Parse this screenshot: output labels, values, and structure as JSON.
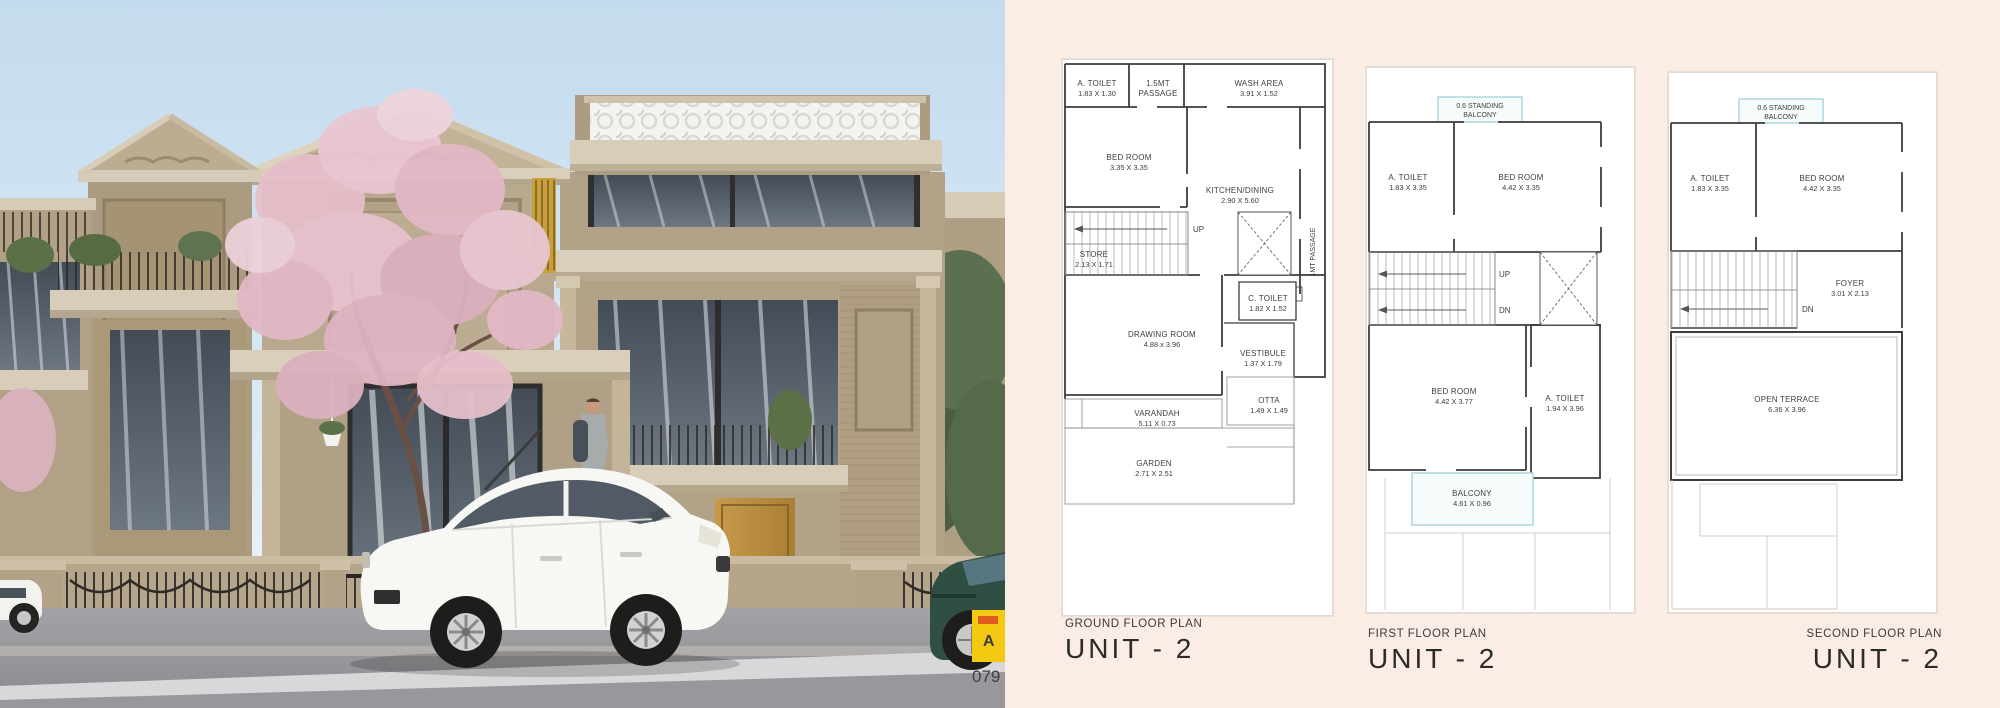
{
  "panel": {
    "background": "#fbede5"
  },
  "plans": [
    {
      "title": "GROUND FLOOR PLAN",
      "unit": "UNIT - 2",
      "rooms": [
        {
          "name": "A. TOILET",
          "dims": "1.83 X 1.30"
        },
        {
          "name": "1.5MT",
          "dims": "PASSAGE"
        },
        {
          "name": "WASH AREA",
          "dims": "3.91 X 1.52"
        },
        {
          "name": "BED ROOM",
          "dims": "3.35 X 3.35"
        },
        {
          "name": "KITCHEN/DINING",
          "dims": "2.90 X 5.60"
        },
        {
          "name": "STORE",
          "dims": "2.13 X 1.71"
        },
        {
          "name": "C. TOILET",
          "dims": "1.82 X 1.52"
        },
        {
          "name": "DRAWING ROOM",
          "dims": "4.88 x 3.96"
        },
        {
          "name": "VESTIBULE",
          "dims": "1.37 X 1.79"
        },
        {
          "name": "OTTA",
          "dims": "1.49 X 1.49"
        },
        {
          "name": "VARANDAH",
          "dims": "5.11 X 0.73"
        },
        {
          "name": "GARDEN",
          "dims": "2.71 X 2.51"
        }
      ],
      "annotations": {
        "up": "UP",
        "side_passage": "1MT PASSAGE"
      }
    },
    {
      "title": "FIRST FLOOR PLAN",
      "unit": "UNIT - 2",
      "rooms": [
        {
          "name": "0.6 STANDING",
          "dims": "BALCONY"
        },
        {
          "name": "A. TOILET",
          "dims": "1.83 X 3.35"
        },
        {
          "name": "BED ROOM",
          "dims": "4.42 X 3.35"
        },
        {
          "name": "BED ROOM",
          "dims": "4.42 X 3.77"
        },
        {
          "name": "A. TOILET",
          "dims": "1.94 X 3.96"
        },
        {
          "name": "BALCONY",
          "dims": "4.61 X 0.96"
        }
      ],
      "annotations": {
        "up": "UP",
        "down": "DN"
      }
    },
    {
      "title": "SECOND FLOOR PLAN",
      "unit": "UNIT - 2",
      "rooms": [
        {
          "name": "0.6 STANDING",
          "dims": "BALCONY"
        },
        {
          "name": "A. TOILET",
          "dims": "1.83 X 3.35"
        },
        {
          "name": "BED ROOM",
          "dims": "4.42 X 3.35"
        },
        {
          "name": "FOYER",
          "dims": "3.01 X 2.13"
        },
        {
          "name": "OPEN TERRACE",
          "dims": "6.36 X 3.96"
        }
      ],
      "annotations": {
        "down": "DN"
      }
    }
  ],
  "photo": {
    "watermark_badge": "A",
    "watermark_number": "079"
  }
}
